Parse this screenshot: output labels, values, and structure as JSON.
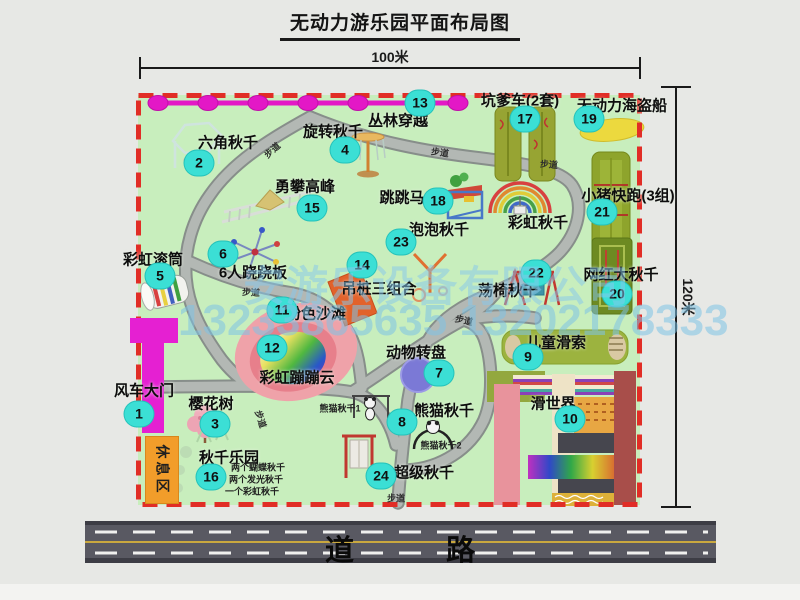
{
  "title": "无动力游乐园平面布局图",
  "dimensions": {
    "width": "100米",
    "height": "120米"
  },
  "road": {
    "label": "道 路"
  },
  "watermark": {
    "company": "安游乐设备有限公司",
    "phone": "13233865635 13202178333"
  },
  "colors": {
    "map_bg": "#c8eebd",
    "border_red": "#e12d26",
    "path_gray": "#b3b8b4",
    "badge_cyan": "#3bdfd5",
    "zipline_magenta": "#e318c6",
    "gate_magenta": "#e520d2",
    "rest_area_orange": "#f29d2a",
    "road_gray": "#595962",
    "beach_pink": "#efa2a9"
  },
  "map": {
    "walkway": "步道",
    "rest_area": "休息区",
    "attractions": [
      {
        "num": "1",
        "label": "风车大门",
        "lx": 144,
        "ly": 390,
        "bx": 139,
        "by": 414
      },
      {
        "num": "2",
        "label": "六角秋千",
        "lx": 228,
        "ly": 142,
        "bx": 199,
        "by": 163
      },
      {
        "num": "3",
        "label": "樱花树",
        "lx": 211,
        "ly": 403,
        "bx": 215,
        "by": 424
      },
      {
        "num": "4",
        "label": "旋转秋千",
        "lx": 333,
        "ly": 131,
        "bx": 345,
        "by": 150
      },
      {
        "num": "5",
        "label": "彩虹滚筒",
        "lx": 153,
        "ly": 259,
        "bx": 160,
        "by": 276
      },
      {
        "num": "6",
        "label": "6人跷跷板",
        "lx": 253,
        "ly": 272,
        "bx": 223,
        "by": 254
      },
      {
        "num": "7",
        "label": "动物转盘",
        "lx": 416,
        "ly": 352,
        "bx": 439,
        "by": 373
      },
      {
        "num": "8",
        "label": "熊猫秋千",
        "lx": 444,
        "ly": 410,
        "bx": 402,
        "by": 422
      },
      {
        "num": "9",
        "label": "儿童滑索",
        "lx": 556,
        "ly": 342,
        "bx": 528,
        "by": 357
      },
      {
        "num": "10",
        "label": "滑世界",
        "lx": 553,
        "ly": 403,
        "bx": 570,
        "by": 419
      },
      {
        "num": "11",
        "label": "粉色沙滩",
        "lx": 316,
        "ly": 313,
        "bx": 282,
        "by": 310
      },
      {
        "num": "12",
        "label": "彩虹蹦蹦云",
        "lx": 297,
        "ly": 377,
        "bx": 272,
        "by": 348
      },
      {
        "num": "13",
        "label": "丛林穿越",
        "lx": 398,
        "ly": 120,
        "bx": 420,
        "by": 103
      },
      {
        "num": "14",
        "label": "吊桩三组合",
        "lx": 379,
        "ly": 288,
        "bx": 362,
        "by": 265
      },
      {
        "num": "15",
        "label": "勇攀高峰",
        "lx": 305,
        "ly": 186,
        "bx": 312,
        "by": 208
      },
      {
        "num": "16",
        "label": "秋千乐园",
        "lx": 229,
        "ly": 457,
        "bx": 211,
        "by": 477
      },
      {
        "num": "17",
        "label": "坑爹车(2套)",
        "lx": 520,
        "ly": 100,
        "bx": 525,
        "by": 119
      },
      {
        "num": "18",
        "label": "跳跳马",
        "lx": 402,
        "ly": 197,
        "bx": 438,
        "by": 201
      },
      {
        "num": "19",
        "label": "无动力海盗船",
        "lx": 622,
        "ly": 105,
        "bx": 589,
        "by": 119
      },
      {
        "num": "20",
        "label": "网红大秋千",
        "lx": 621,
        "ly": 274,
        "bx": 617,
        "by": 294
      },
      {
        "num": "21",
        "label": "小猪快跑(3组)",
        "lx": 628,
        "ly": 195,
        "bx": 602,
        "by": 212
      },
      {
        "num": "22",
        "label": "荡椅秋千",
        "lx": 508,
        "ly": 290,
        "bx": 536,
        "by": 273
      },
      {
        "num": "23",
        "label": "泡泡秋千",
        "lx": 439,
        "ly": 229,
        "bx": 401,
        "by": 242
      },
      {
        "num": "24",
        "label": "超级秋千",
        "lx": 424,
        "ly": 472,
        "bx": 381,
        "by": 476
      },
      {
        "num": "",
        "label": "彩虹秋千",
        "lx": 538,
        "ly": 222,
        "bx": 0,
        "by": 0
      }
    ],
    "sub_labels": [
      {
        "text": "熊猫秋千1",
        "x": 340,
        "y": 408
      },
      {
        "text": "熊猫秋千2",
        "x": 441,
        "y": 445
      },
      {
        "text": "两个蝴蝶秋千",
        "x": 258,
        "y": 467
      },
      {
        "text": "两个发光秋千",
        "x": 256,
        "y": 479
      },
      {
        "text": "一个彩虹秋千",
        "x": 252,
        "y": 491
      }
    ],
    "walkway_labels": [
      {
        "x": 272,
        "y": 150,
        "rot": -42
      },
      {
        "x": 440,
        "y": 152,
        "rot": 8
      },
      {
        "x": 549,
        "y": 164,
        "rot": 5
      },
      {
        "x": 251,
        "y": 292,
        "rot": 3
      },
      {
        "x": 464,
        "y": 320,
        "rot": 12
      },
      {
        "x": 261,
        "y": 419,
        "rot": 72
      },
      {
        "x": 396,
        "y": 498,
        "rot": 0
      }
    ]
  }
}
